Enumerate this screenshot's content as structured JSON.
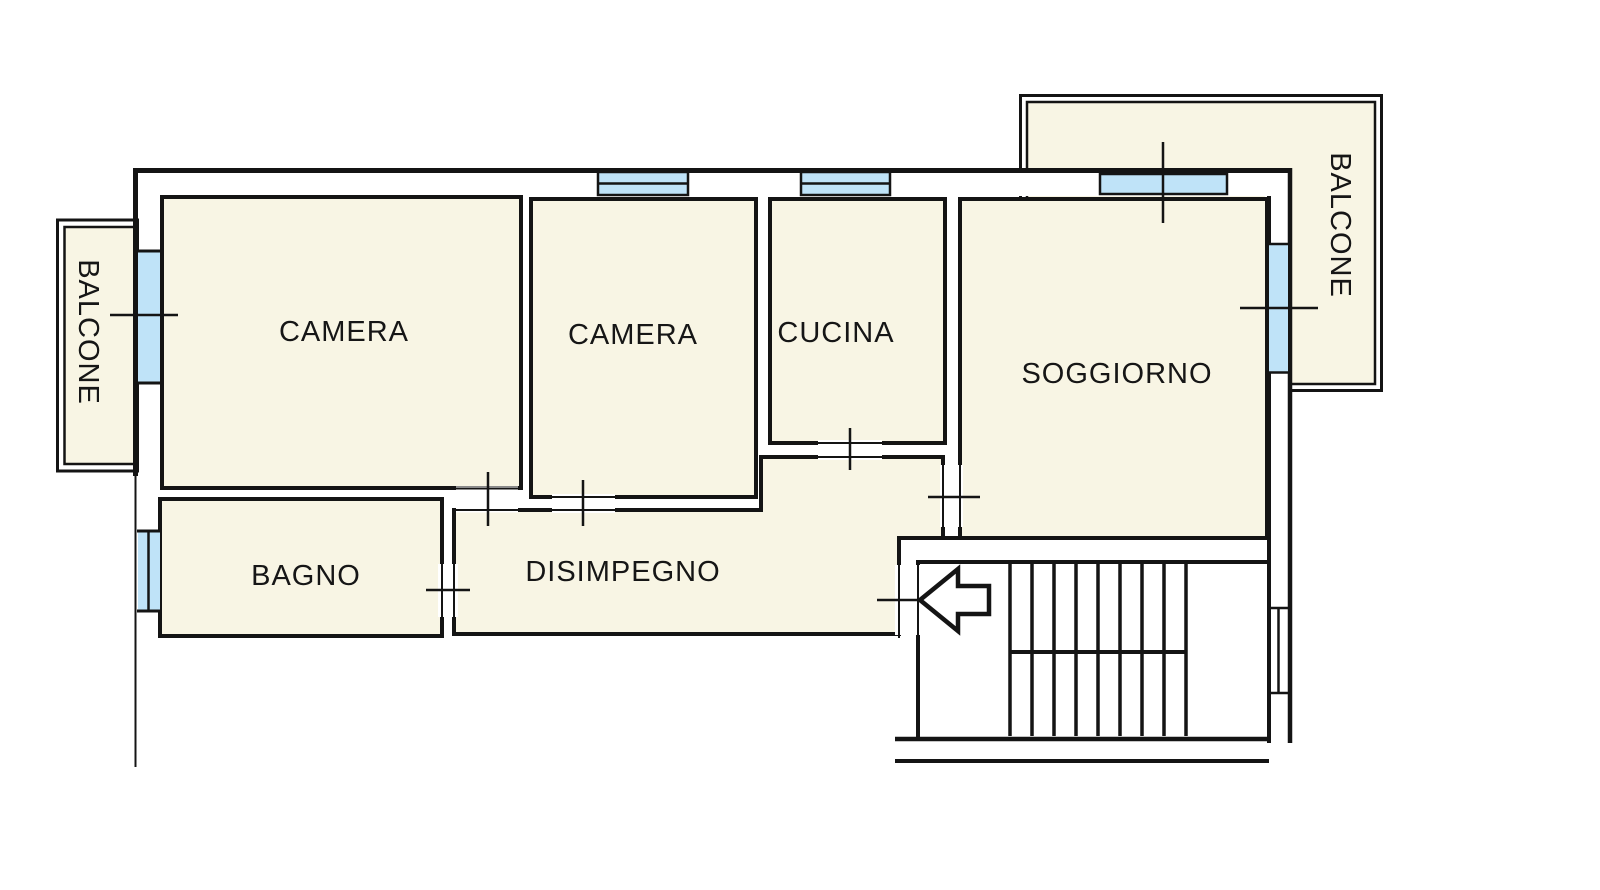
{
  "document": {
    "type": "floor-plan",
    "language": "it"
  },
  "colors": {
    "background": "#FFFFFF",
    "room_fill": "#F8F5E4",
    "window_fill": "#BFE3F8",
    "wall_line": "#141414"
  },
  "rooms": [
    {
      "id": "camera-1",
      "label": "CAMERA"
    },
    {
      "id": "camera-2",
      "label": "CAMERA"
    },
    {
      "id": "cucina",
      "label": "CUCINA"
    },
    {
      "id": "soggiorno",
      "label": "SOGGIORNO"
    },
    {
      "id": "bagno",
      "label": "BAGNO"
    },
    {
      "id": "disimpegno",
      "label": "DISIMPEGNO"
    }
  ],
  "balconies": [
    {
      "id": "balcone-west",
      "label": "BALCONE"
    },
    {
      "id": "balcone-east",
      "label": "BALCONE"
    }
  ],
  "features": {
    "windows": [
      "camera-1-west",
      "bagno-west",
      "camera-2-north",
      "cucina-north",
      "soggiorno-north",
      "soggiorno-east"
    ],
    "doors": [
      "camera-1-disimpegno",
      "camera-2-disimpegno",
      "cucina-disimpegno",
      "soggiorno-disimpegno",
      "bagno-disimpegno",
      "entrance"
    ],
    "stairs": {
      "tread_columns": 8,
      "landing": true
    },
    "entrance_arrow": {
      "direction": "left"
    }
  }
}
